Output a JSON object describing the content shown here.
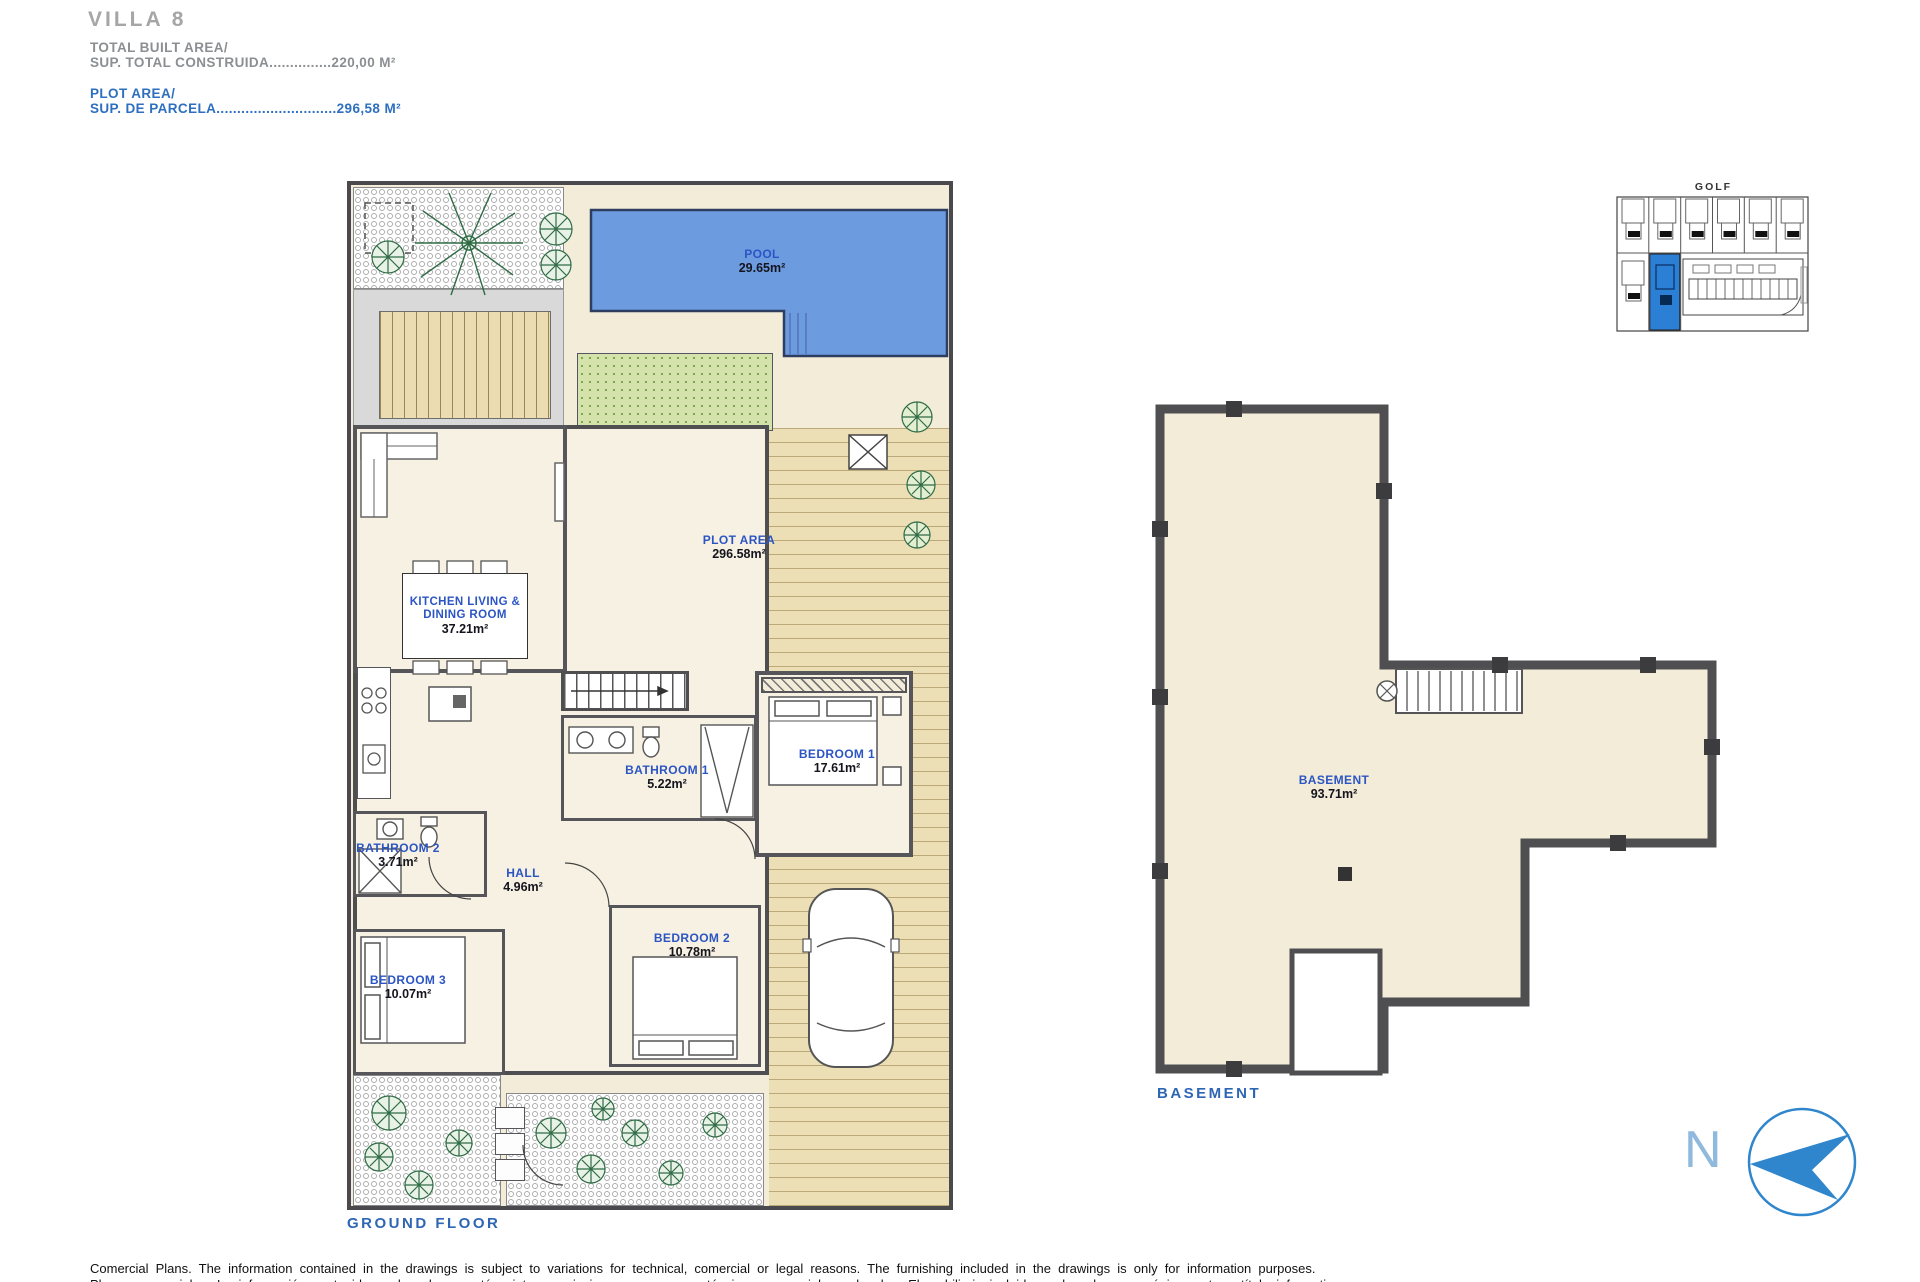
{
  "header": {
    "title": "VILLA 8",
    "built_area_label": "TOTAL BUILT AREA/",
    "built_area_value": "SUP. TOTAL CONSTRUIDA...............220,00 M²",
    "plot_area_label": "PLOT AREA/",
    "plot_area_value": "SUP. DE PARCELA.............................296,58 M²"
  },
  "ground_floor": {
    "caption": "GROUND FLOOR",
    "labels": {
      "pool": {
        "name": "POOL",
        "area": "29.65m²"
      },
      "plot": {
        "name": "PLOT AREA",
        "area": "296.58m²"
      },
      "kitchen": {
        "name": "KITCHEN LIVING & DINING ROOM",
        "area": "37.21m²"
      },
      "bathroom1": {
        "name": "BATHROOM 1",
        "area": "5.22m²"
      },
      "bedroom1": {
        "name": "BEDROOM 1",
        "area": "17.61m²"
      },
      "bathroom2": {
        "name": "BATHROOM 2",
        "area": "3.71m²"
      },
      "hall": {
        "name": "HALL",
        "area": "4.96m²"
      },
      "bedroom2": {
        "name": "BEDROOM 2",
        "area": "10.78m²"
      },
      "bedroom3": {
        "name": "BEDROOM 3",
        "area": "10.07m²"
      }
    }
  },
  "basement": {
    "caption": "BASEMENT",
    "label": {
      "name": "BASEMENT",
      "area": "93.71m²"
    }
  },
  "site_plan": {
    "title": "GOLF"
  },
  "compass": {
    "label": "N"
  },
  "footer": {
    "line1": "Comercial Plans. The information contained in the drawings is subject to variations for technical, comercial or legal reasons. The furnishing included in the drawings is only for information purposes.",
    "line2": "Planos comerciales. La información contenida en los planos está sujeta a variaciones por razones técnicas, comerciales o legales. El mobiliario incluido en los planos es únicamente a título informativo."
  },
  "colors": {
    "accent_blue": "#2e6fc0",
    "label_blue": "#2c55c4",
    "pool_blue": "#6d9be0",
    "highlight_blue": "#2b7fd4",
    "wall_gray": "#4f4f52",
    "title_gray": "#a6a6a6"
  }
}
